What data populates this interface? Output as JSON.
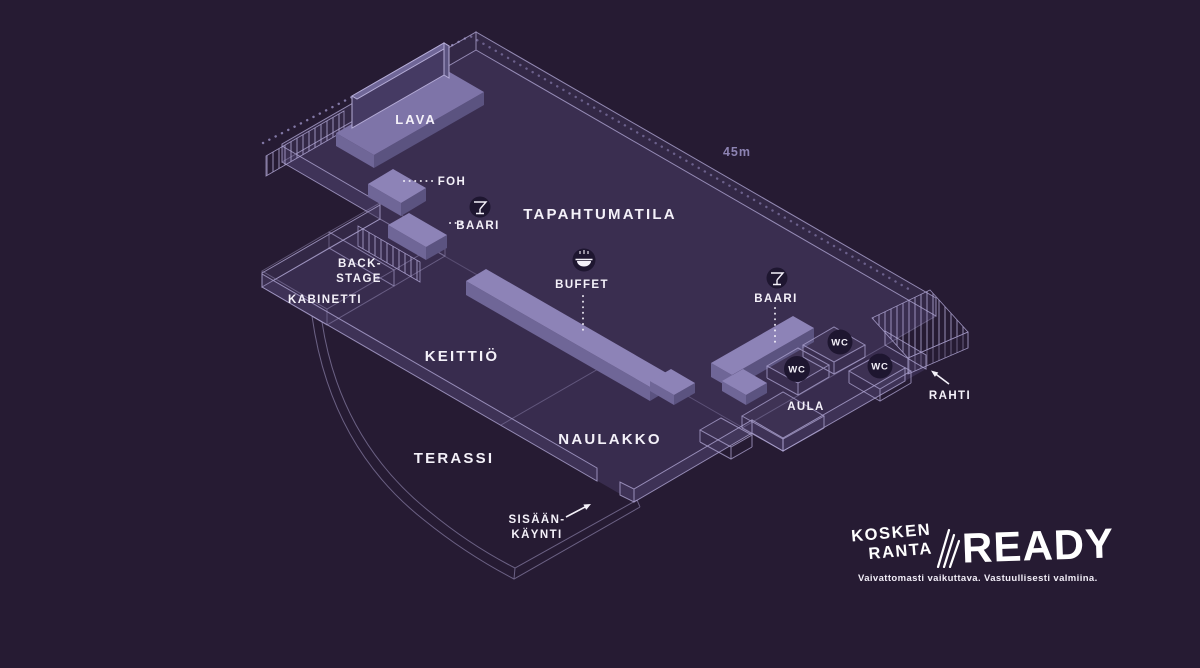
{
  "title": "Koskenranta venue floor plan",
  "colors": {
    "background": "#261b33",
    "floor": "#3a2e50",
    "wall_line": "#b0a6d4",
    "furniture_top": "#8d83b7",
    "furniture_side_light": "#6f6697",
    "furniture_side_dark": "#5b5380",
    "badge": "#1e1630",
    "label_text": "#f4f1f9",
    "dimension_text": "#8d83b3"
  },
  "plan": {
    "dimension_label": "45m",
    "areas": {
      "stage": "LAVA",
      "foh": "FOH",
      "stage_bar": "BAARI",
      "event_hall": "TAPAHTUMATILA",
      "buffet": "BUFFET",
      "backstage_line1": "BACK-",
      "backstage_line2": "STAGE",
      "cabinet": "KABINETTI",
      "kitchen": "KEITTIÖ",
      "main_bar": "BAARI",
      "wc_left": "WC",
      "wc_top": "WC",
      "wc_right": "WC",
      "lobby": "AULA",
      "freight": "RAHTI",
      "cloakroom": "NAULAKKO",
      "terrace": "TERASSI",
      "entrance_line1": "SISÄÄN-",
      "entrance_line2": "KÄYNTI"
    },
    "icons": {
      "stage_bar": "martini-glass-icon",
      "main_bar": "martini-glass-icon",
      "buffet": "food-bowl-icon"
    }
  },
  "logo": {
    "name_line1": "KOSKEN",
    "name_line2": "RANTA",
    "brand": "READY",
    "tagline": "Vaivattomasti vaikuttava. Vastuullisesti valmiina."
  }
}
